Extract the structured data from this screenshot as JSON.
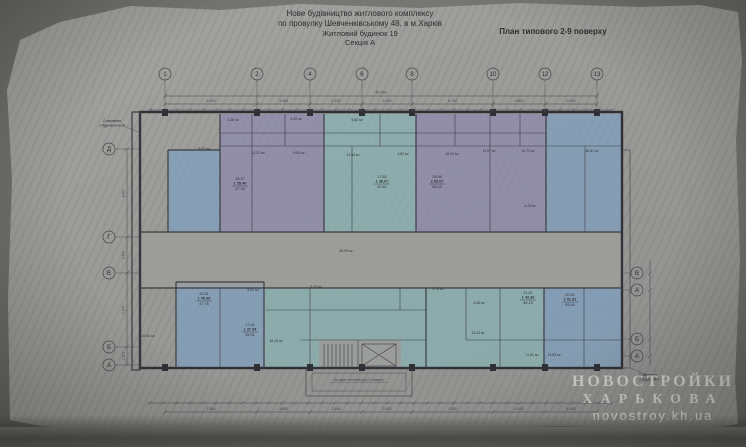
{
  "colors": {
    "purple": "#8d89ae",
    "teal": "#88b4b6",
    "blue": "#7fa1c1",
    "paper": "#9c9c99",
    "line": "#2f2f36",
    "thin": "#3c3c44",
    "dim": "#45454c",
    "watermark": "#d8d8d2"
  },
  "header": {
    "line1": "Нове будівництво житлового комплексу",
    "line2": "по провулку Шевченківському 48, в м.Харків",
    "line3": "Житловий будинок 19",
    "line4": "Секція А",
    "plan_label": "План типового 2-9 поверху"
  },
  "watermark": {
    "line1": "НОВОСТРОЙКИ",
    "line2": "ХАРЬКОВА",
    "line3": "novostroy.kh.ua"
  },
  "plan": {
    "axes_top": [
      {
        "label": "1",
        "x": 165
      },
      {
        "label": "2",
        "x": 257
      },
      {
        "label": "4",
        "x": 310
      },
      {
        "label": "6",
        "x": 362
      },
      {
        "label": "8",
        "x": 412
      },
      {
        "label": "10",
        "x": 493
      },
      {
        "label": "12",
        "x": 545
      },
      {
        "label": "13",
        "x": 597
      }
    ],
    "axes_left": [
      {
        "label": "Д",
        "y": 149
      },
      {
        "label": "Г",
        "y": 237
      },
      {
        "label": "В",
        "y": 273
      },
      {
        "label": "Б",
        "y": 347
      },
      {
        "label": "А",
        "y": 365
      }
    ],
    "axes_right": [
      {
        "label": "В",
        "y": 273
      },
      {
        "label": "А",
        "y": 290
      },
      {
        "label": "Б",
        "y": 339
      },
      {
        "label": "А",
        "y": 356
      }
    ],
    "dims": {
      "top_total": "40.500",
      "top_spans": [
        "6.300",
        "3.150",
        "3.150",
        "3.150",
        "5.700",
        "3.600",
        "3.000"
      ],
      "bottom_spans": [
        "7.500",
        "3.600",
        "2.400",
        "2.400",
        "4.300",
        "4.100",
        "4.500"
      ],
      "left_spans": [
        "8.800",
        "3.600",
        "7.300",
        "1.800"
      ]
    },
    "units": [
      {
        "color": "blue",
        "x": 168,
        "y": 150,
        "w": 52,
        "h": 82
      },
      {
        "color": "purple",
        "x": 220,
        "y": 114,
        "w": 104,
        "h": 118
      },
      {
        "color": "teal",
        "x": 324,
        "y": 114,
        "w": 92,
        "h": 118
      },
      {
        "color": "purple",
        "x": 416,
        "y": 114,
        "w": 130,
        "h": 118
      },
      {
        "color": "blue",
        "x": 546,
        "y": 114,
        "w": 76,
        "h": 118
      },
      {
        "color": "blue",
        "x": 176,
        "y": 282,
        "w": 88,
        "h": 86
      },
      {
        "color": "teal",
        "x": 264,
        "y": 288,
        "w": 162,
        "h": 80
      },
      {
        "color": "teal",
        "x": 426,
        "y": 288,
        "w": 118,
        "h": 80
      },
      {
        "color": "blue",
        "x": 544,
        "y": 288,
        "w": 78,
        "h": 80
      }
    ],
    "stamps": [
      {
        "x": 240,
        "y": 180,
        "lines": [
          "15.27",
          "1 35.40",
          "37.26"
        ]
      },
      {
        "x": 382,
        "y": 178,
        "lines": [
          "17.82",
          "1 38.07",
          "40.81"
        ]
      },
      {
        "x": 437,
        "y": 178,
        "lines": [
          "29.98",
          "2 53.67",
          "56.16"
        ]
      },
      {
        "x": 204,
        "y": 295,
        "lines": [
          "20.01",
          "1 45.38",
          "47.76"
        ]
      },
      {
        "x": 250,
        "y": 326,
        "lines": [
          "17.41",
          "1 27.34",
          "29.31"
        ]
      },
      {
        "x": 528,
        "y": 294,
        "lines": [
          "21.41",
          "1 43.36",
          "46.19"
        ]
      },
      {
        "x": 570,
        "y": 296,
        "lines": [
          "20.52",
          "1 51.81",
          "53.44"
        ]
      }
    ],
    "room_labels": [
      {
        "text": "8.57 м²",
        "x": 204,
        "y": 150
      },
      {
        "text": "4.28 м²",
        "x": 233,
        "y": 121
      },
      {
        "text": "4.29 м²",
        "x": 296,
        "y": 120
      },
      {
        "text": "5.82 м²",
        "x": 357,
        "y": 121
      },
      {
        "text": "13.22 м²",
        "x": 258,
        "y": 154
      },
      {
        "text": "9.05 м²",
        "x": 299,
        "y": 154
      },
      {
        "text": "11.54 м²",
        "x": 353,
        "y": 156
      },
      {
        "text": "3.82 м²",
        "x": 403,
        "y": 155
      },
      {
        "text": "10.01 м²",
        "x": 452,
        "y": 155
      },
      {
        "text": "11.07 м²",
        "x": 489,
        "y": 152
      },
      {
        "text": "12.73 м²",
        "x": 528,
        "y": 152
      },
      {
        "text": "16.81 м²",
        "x": 592,
        "y": 152
      },
      {
        "text": "4.23 м²",
        "x": 530,
        "y": 207
      },
      {
        "text": "60.09 м²",
        "x": 346,
        "y": 252
      },
      {
        "text": "5.23 м²",
        "x": 316,
        "y": 288
      },
      {
        "text": "5.91 м²",
        "x": 253,
        "y": 291
      },
      {
        "text": "4.73 м²",
        "x": 438,
        "y": 290
      },
      {
        "text": "4.06 м²",
        "x": 479,
        "y": 304
      },
      {
        "text": "11.24 м²",
        "x": 478,
        "y": 334
      },
      {
        "text": "11.61 м²",
        "x": 532,
        "y": 356
      },
      {
        "text": "13.53 м²",
        "x": 554,
        "y": 356
      },
      {
        "text": "10.01 м²",
        "x": 148,
        "y": 337
      },
      {
        "text": "16.13 м²",
        "x": 276,
        "y": 342
      }
    ],
    "notes": {
      "left": [
        "Стикування",
        "з будинком №18"
      ],
      "right": [
        "Стикування",
        "з будинком"
      ],
      "canopy": "Козирок типовий для 2 поверху"
    }
  }
}
